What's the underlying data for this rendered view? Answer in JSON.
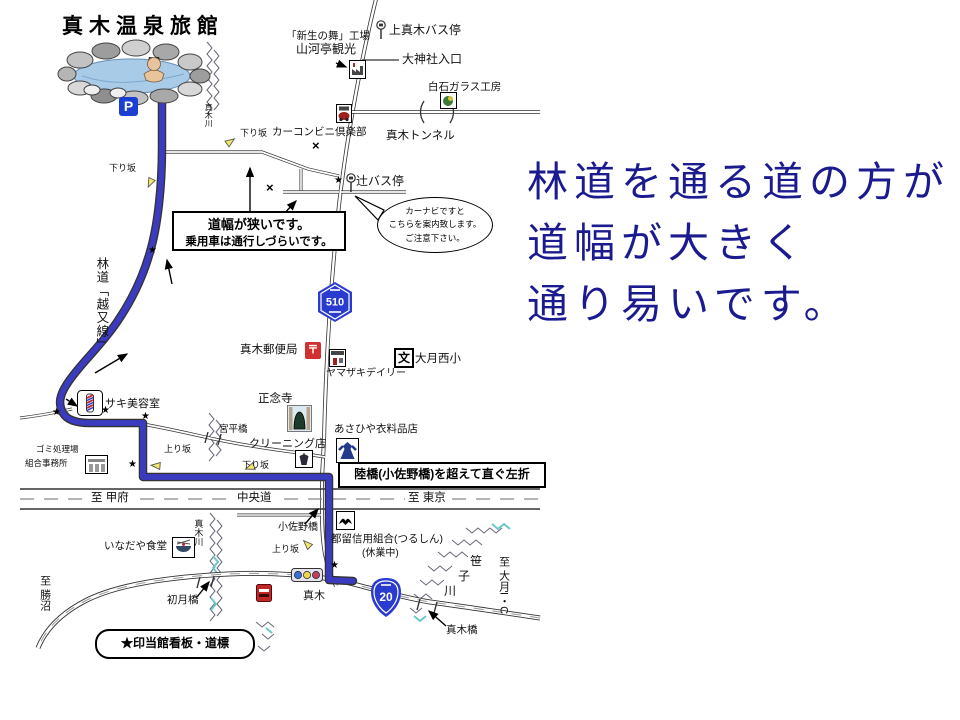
{
  "right_note": {
    "color": "#1b1b8f",
    "lines": [
      "林道を通る道の方が",
      "道幅が大きく",
      "通り易いです。"
    ]
  },
  "map": {
    "title": "真木温泉旅館",
    "parking": "P",
    "shields": {
      "prefectural": "510",
      "national": "20"
    },
    "symbols": {
      "star": "★",
      "cross": "×",
      "school": "文",
      "post": "〒"
    },
    "boxes": {
      "narrow1": "道幅が狭いです。",
      "narrow2": "乗用車は通行しづらいです。",
      "overpass": "陸橋(小佐野橋)を超えて直ぐ左折",
      "legend": "★印当館看板・道標"
    },
    "bubble": {
      "l1": "カーナビですと",
      "l2": "こちらを案内致します。",
      "l3": "ご注意下さい。"
    },
    "labels": {
      "kamimaki_bus": "上真木バス停",
      "factory": "「新生の舞」工場",
      "sangatei": "山河亭観光",
      "daijinja": "大神社入口",
      "shiraishi": "白石ガラス工房",
      "tunnel": "真木トンネル",
      "carclub": "カーコンビニ倶楽部",
      "down1": "下り坂",
      "down2": "下り坂",
      "down3": "下り坂",
      "up1": "上り坂",
      "up2": "上り坂",
      "tsuji_bus": "辻バス停",
      "rindo": "林道「越又線」",
      "maki_river_top": "真木川",
      "maki_river_bottom": "真木川",
      "post_office": "真木郵便局",
      "yamazaki": "ヤマザキデイリー",
      "school_name": "大月西小",
      "shonenji": "正念寺",
      "miyadaira": "宮平橋",
      "cleaning": "クリーニング店",
      "saki": "サキ美容室",
      "gomi1": "ゴミ処理場",
      "gomi2": "組合事務所",
      "asahiya": "あさひや衣料品店",
      "to_kofu": "至 甲府",
      "chuodo": "中央道",
      "to_tokyo": "至 東京",
      "kosano": "小佐野橋",
      "tsurushin": "都留信用組合(つるしん)",
      "kyugyo": "(休業中)",
      "inadaya": "いなだや食堂",
      "hatsuki": "初月橋",
      "maki_cross": "真木",
      "to_katsunuma": "至 勝沼",
      "sasa1": "笹",
      "sasa2": "子",
      "sasa3": "川",
      "to_otsuki_ic": "至 大月I・C",
      "makibashi": "真木橋"
    }
  }
}
